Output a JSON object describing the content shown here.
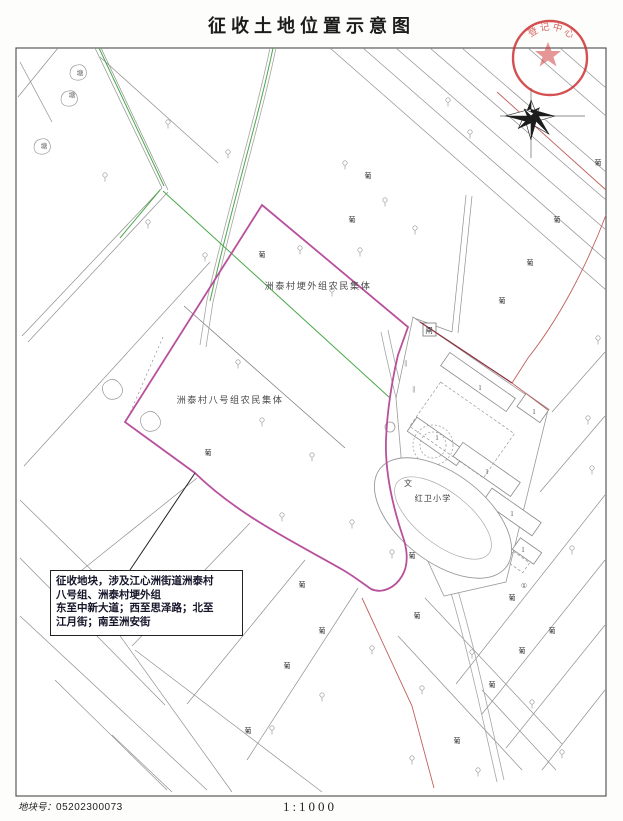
{
  "title": "征收土地位置示意图",
  "seal": {
    "text": "登记中心"
  },
  "map": {
    "labels": {
      "collective1": "洲泰村埂外组农民集体",
      "collective2": "洲泰村八号组农民集体",
      "school": "红卫小学",
      "school_symbol": "文",
      "sluice": "闸",
      "pond": "塘",
      "vineyard": "葡",
      "floor_one": "1",
      "circled_one": "①",
      "slope_mark": "∥"
    },
    "annotation": {
      "lines": [
        "征收地块，涉及江心洲街道洲泰村",
        "八号组、洲泰村埂外组",
        "东至中新大道；西至思泽路；北至",
        "江月街；南至洲安街"
      ]
    },
    "colors": {
      "boundary": "#b8509c",
      "road_red": "#c0605c",
      "green": "#4aa84a",
      "seal_red": "#cc3333"
    }
  },
  "footer": {
    "parcel_label": "地块号：",
    "parcel_number": "05202300073",
    "scale": "1:1000"
  }
}
